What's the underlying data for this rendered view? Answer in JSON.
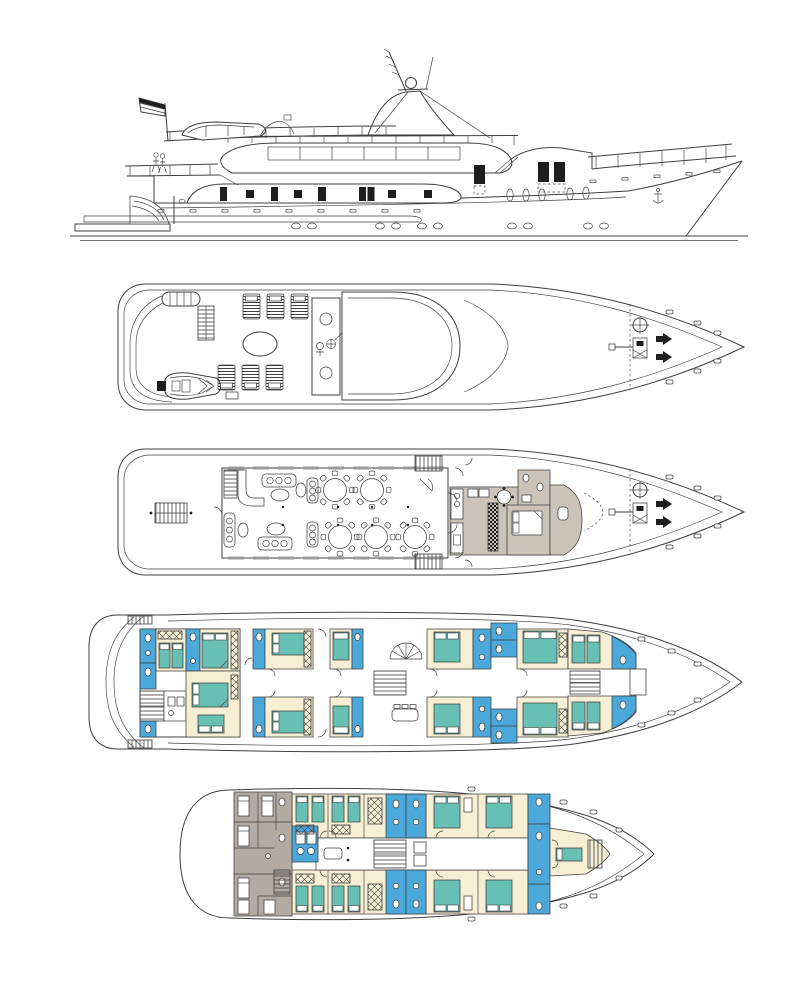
{
  "canvas": {
    "width": 796,
    "height": 1000
  },
  "colors": {
    "paper": "#ffffff",
    "ink": "#3f3f3f",
    "inkSoft": "#9a9a9a",
    "cream": "#f6efd3",
    "teal": "#68c0b4",
    "blue": "#4ba8db",
    "taupe": "#cbc2b8",
    "gray": "#b3aaa2",
    "dark": "#1e1e1e"
  },
  "views": [
    {
      "id": "side-profile-elevation"
    },
    {
      "id": "sun-deck-plan"
    },
    {
      "id": "main-deck-plan"
    },
    {
      "id": "cabin-deck-plan"
    },
    {
      "id": "lower-deck-plan"
    }
  ],
  "color_legend": {
    "teal": "bed",
    "blue": "bathroom",
    "cream": "cabin-floor",
    "taupe": "galley-service-area",
    "gray": "crew-area"
  },
  "counts": {
    "deck_plans": 4,
    "sun_loungers": 6,
    "dining_tables": 5
  }
}
